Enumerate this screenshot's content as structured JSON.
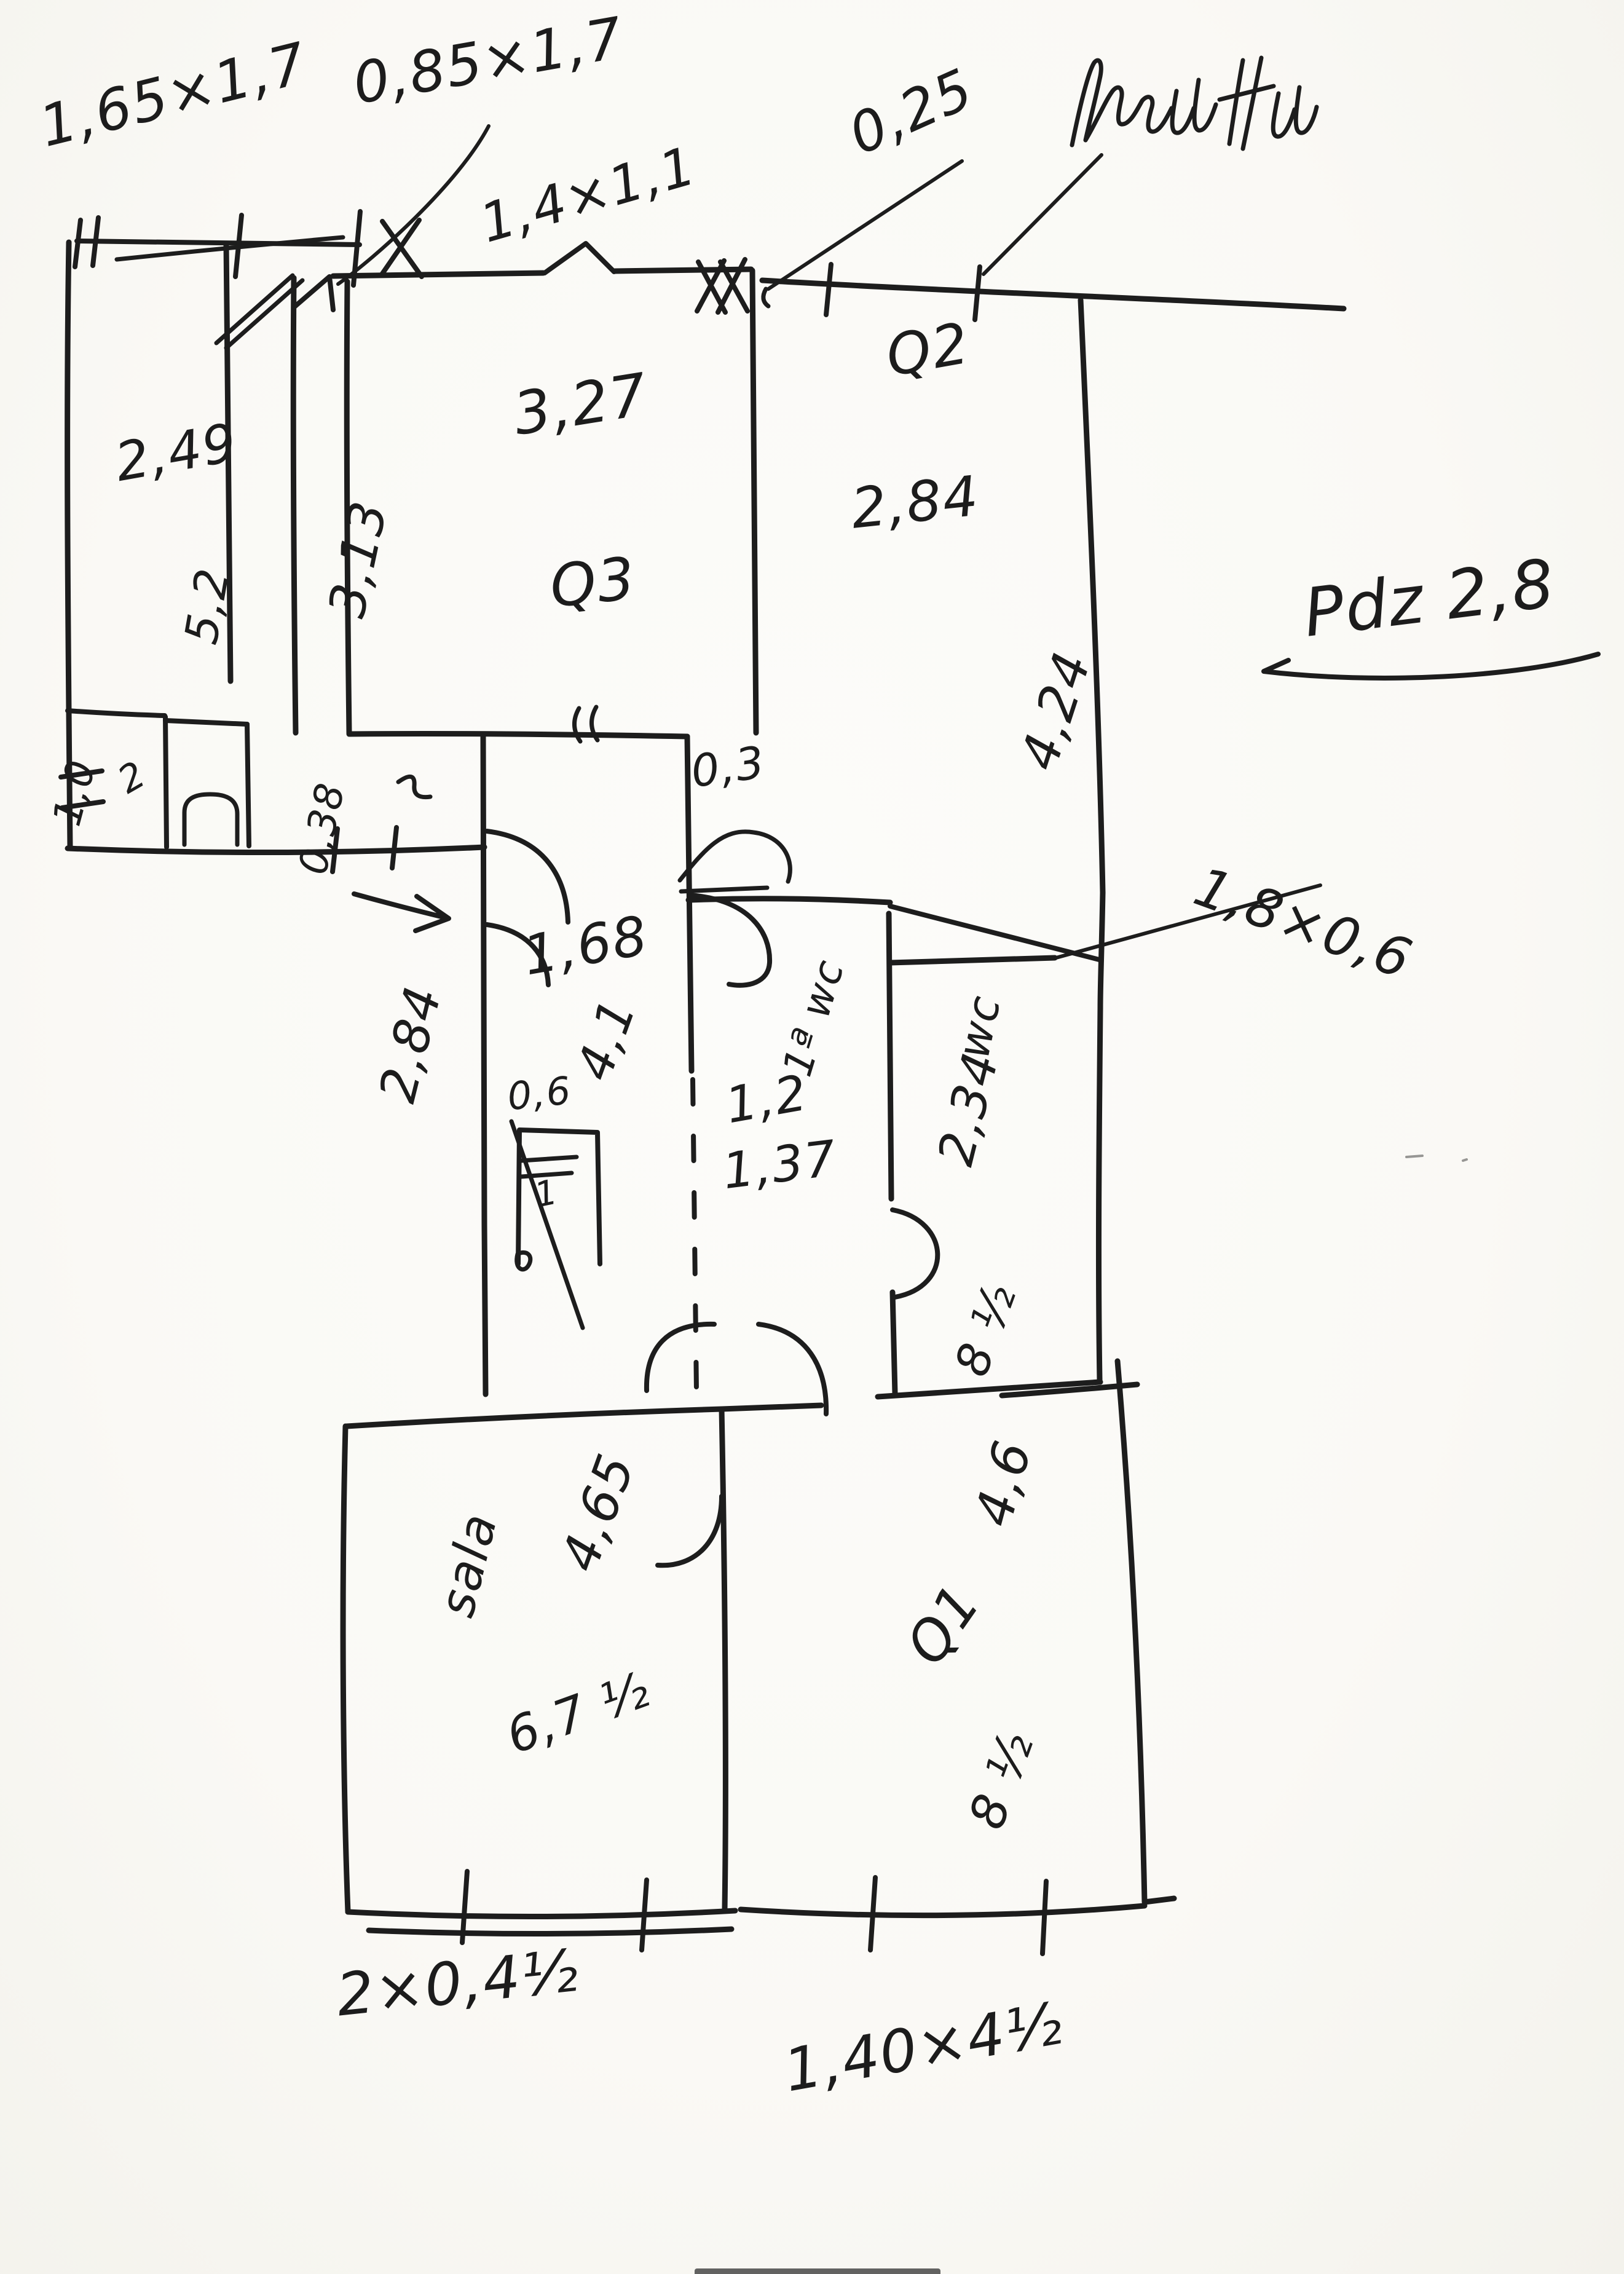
{
  "paper": {
    "kind": "hand-drawn floor plan sketch, black marker on white paper",
    "background": "#faf9f5",
    "ink": "#1d1d1d"
  },
  "labels": {
    "top": {
      "door_a": "1,65×1,7",
      "door_b": "0,85×1,7",
      "window": "1,4×1,1",
      "offset": "0,25"
    },
    "note": "Pdz 2,8",
    "left_room": {
      "dim_w": "2,49",
      "dim_h": "5,2"
    },
    "q3": {
      "name": "Q3",
      "dim_w": "3,27",
      "dim_h": "3,13"
    },
    "q2": {
      "name": "Q2",
      "dim_w": "2,84",
      "dim_h": "4,24"
    },
    "alcove": {
      "dim": "1,0",
      "mark": "2"
    },
    "passage": {
      "door": "0,38"
    },
    "hall": {
      "stub": "0,3",
      "dim_w": "1,68",
      "dim_h": "4,1",
      "outer": "2,84",
      "closet_w": "0,6",
      "closet_mark": "1"
    },
    "bath": {
      "name": "1ª wc",
      "dim_w": "1,2",
      "dim_part": "1,37"
    },
    "wc": {
      "name": "wc",
      "dim_h": "2,34",
      "corner": "8 ½",
      "window": "1,8×0,6"
    },
    "sala": {
      "name": "sala",
      "dim_w": "4,65",
      "bottom": "6,7 ½"
    },
    "q1": {
      "name": "Q1",
      "dim_h": "4,6",
      "corner": "8 ½"
    },
    "bottom": {
      "left": "2×0,4½",
      "right": "1,40×4½"
    }
  }
}
